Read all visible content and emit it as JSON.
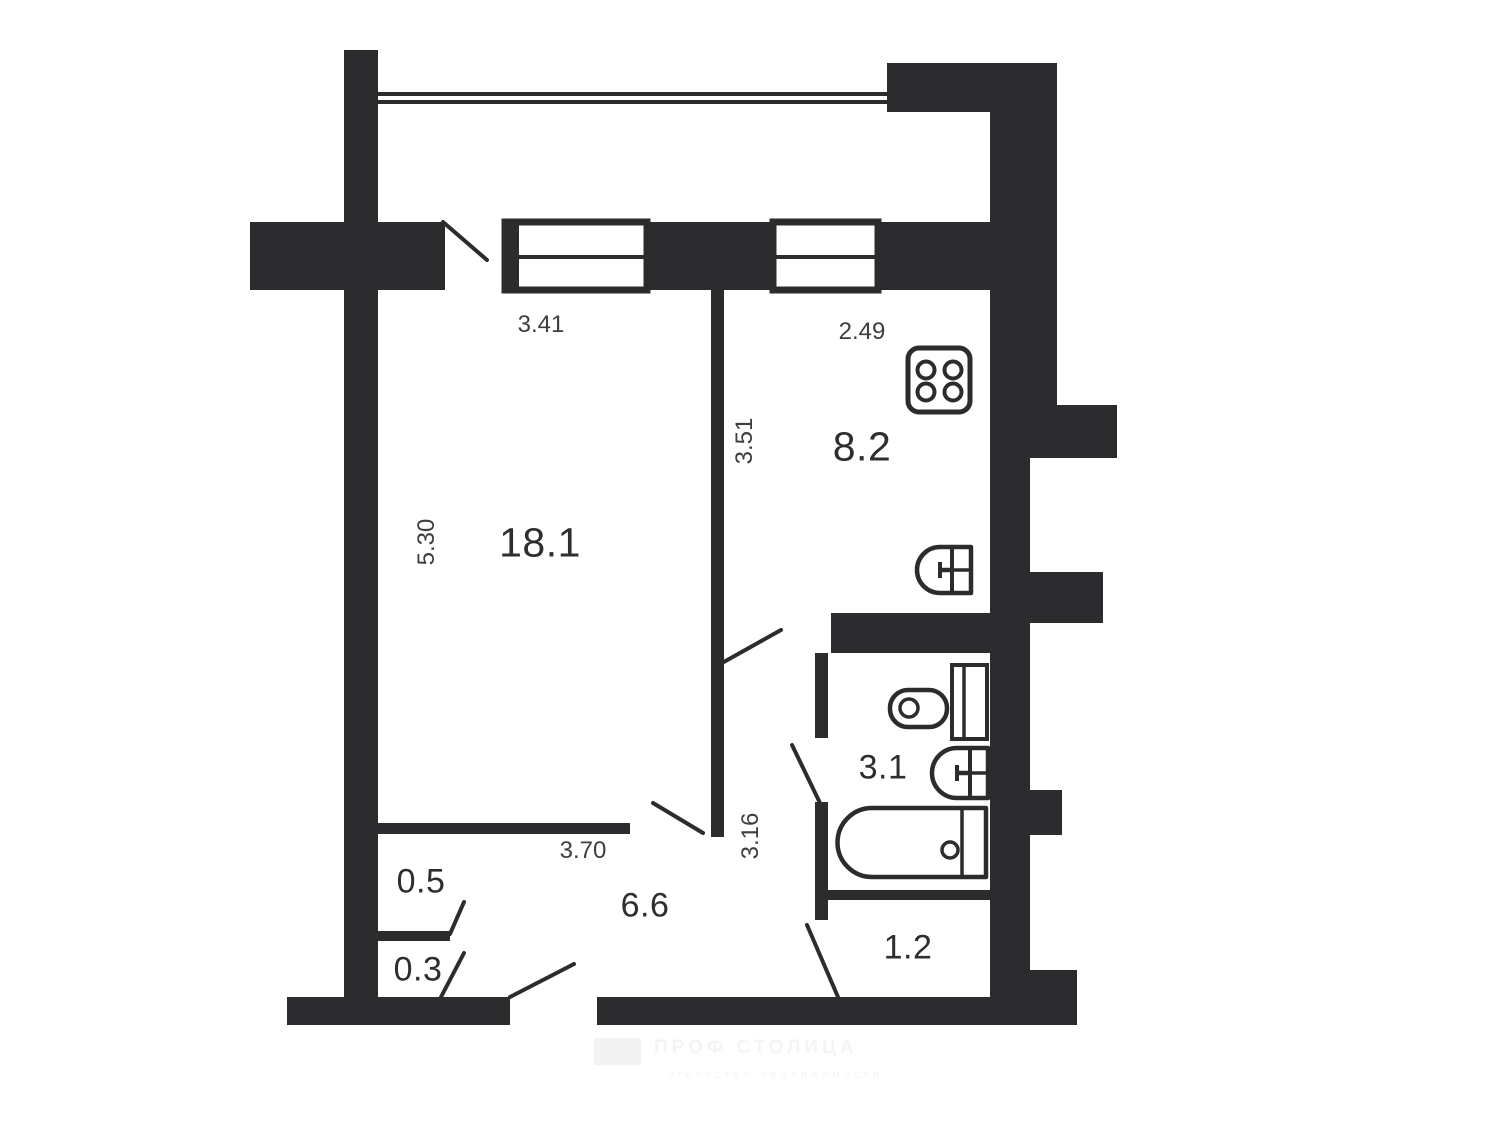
{
  "plan": {
    "title": "apartment-floor-plan",
    "background_color": "#ffffff",
    "wall_color": "#2c2c2e",
    "line_color": "#2c2c2e",
    "room_label_color": "#2e2e2e",
    "dim_label_color": "#3e3e3e",
    "rooms": [
      {
        "id": "living-room",
        "area": "18.1",
        "x": 540,
        "y": 543,
        "size": 41
      },
      {
        "id": "kitchen",
        "area": "8.2",
        "x": 862,
        "y": 447,
        "size": 41
      },
      {
        "id": "bathroom",
        "area": "3.1",
        "x": 883,
        "y": 768,
        "size": 34
      },
      {
        "id": "hallway",
        "area": "6.6",
        "x": 645,
        "y": 906,
        "size": 34
      },
      {
        "id": "closet-upper",
        "area": "0.5",
        "x": 421,
        "y": 882,
        "size": 34
      },
      {
        "id": "closet-lower",
        "area": "0.3",
        "x": 418,
        "y": 970,
        "size": 34
      },
      {
        "id": "entry",
        "area": "1.2",
        "x": 908,
        "y": 948,
        "size": 34
      }
    ],
    "dimensions": [
      {
        "value": "3.41",
        "x": 541,
        "y": 325,
        "rotated": false
      },
      {
        "value": "2.49",
        "x": 862,
        "y": 332,
        "rotated": false
      },
      {
        "value": "5.30",
        "x": 427,
        "y": 542,
        "rotated": true
      },
      {
        "value": "3.51",
        "x": 745,
        "y": 441,
        "rotated": true
      },
      {
        "value": "3.70",
        "x": 583,
        "y": 851,
        "rotated": false
      },
      {
        "value": "3.16",
        "x": 751,
        "y": 836,
        "rotated": true
      }
    ],
    "fixtures": [
      "stove",
      "kitchen-sink",
      "toilet",
      "cistern",
      "bathroom-sink",
      "bathtub"
    ],
    "watermark": {
      "line1": "ПРОФ СТОЛИЦА",
      "line2": "агентство недвижимости"
    }
  }
}
